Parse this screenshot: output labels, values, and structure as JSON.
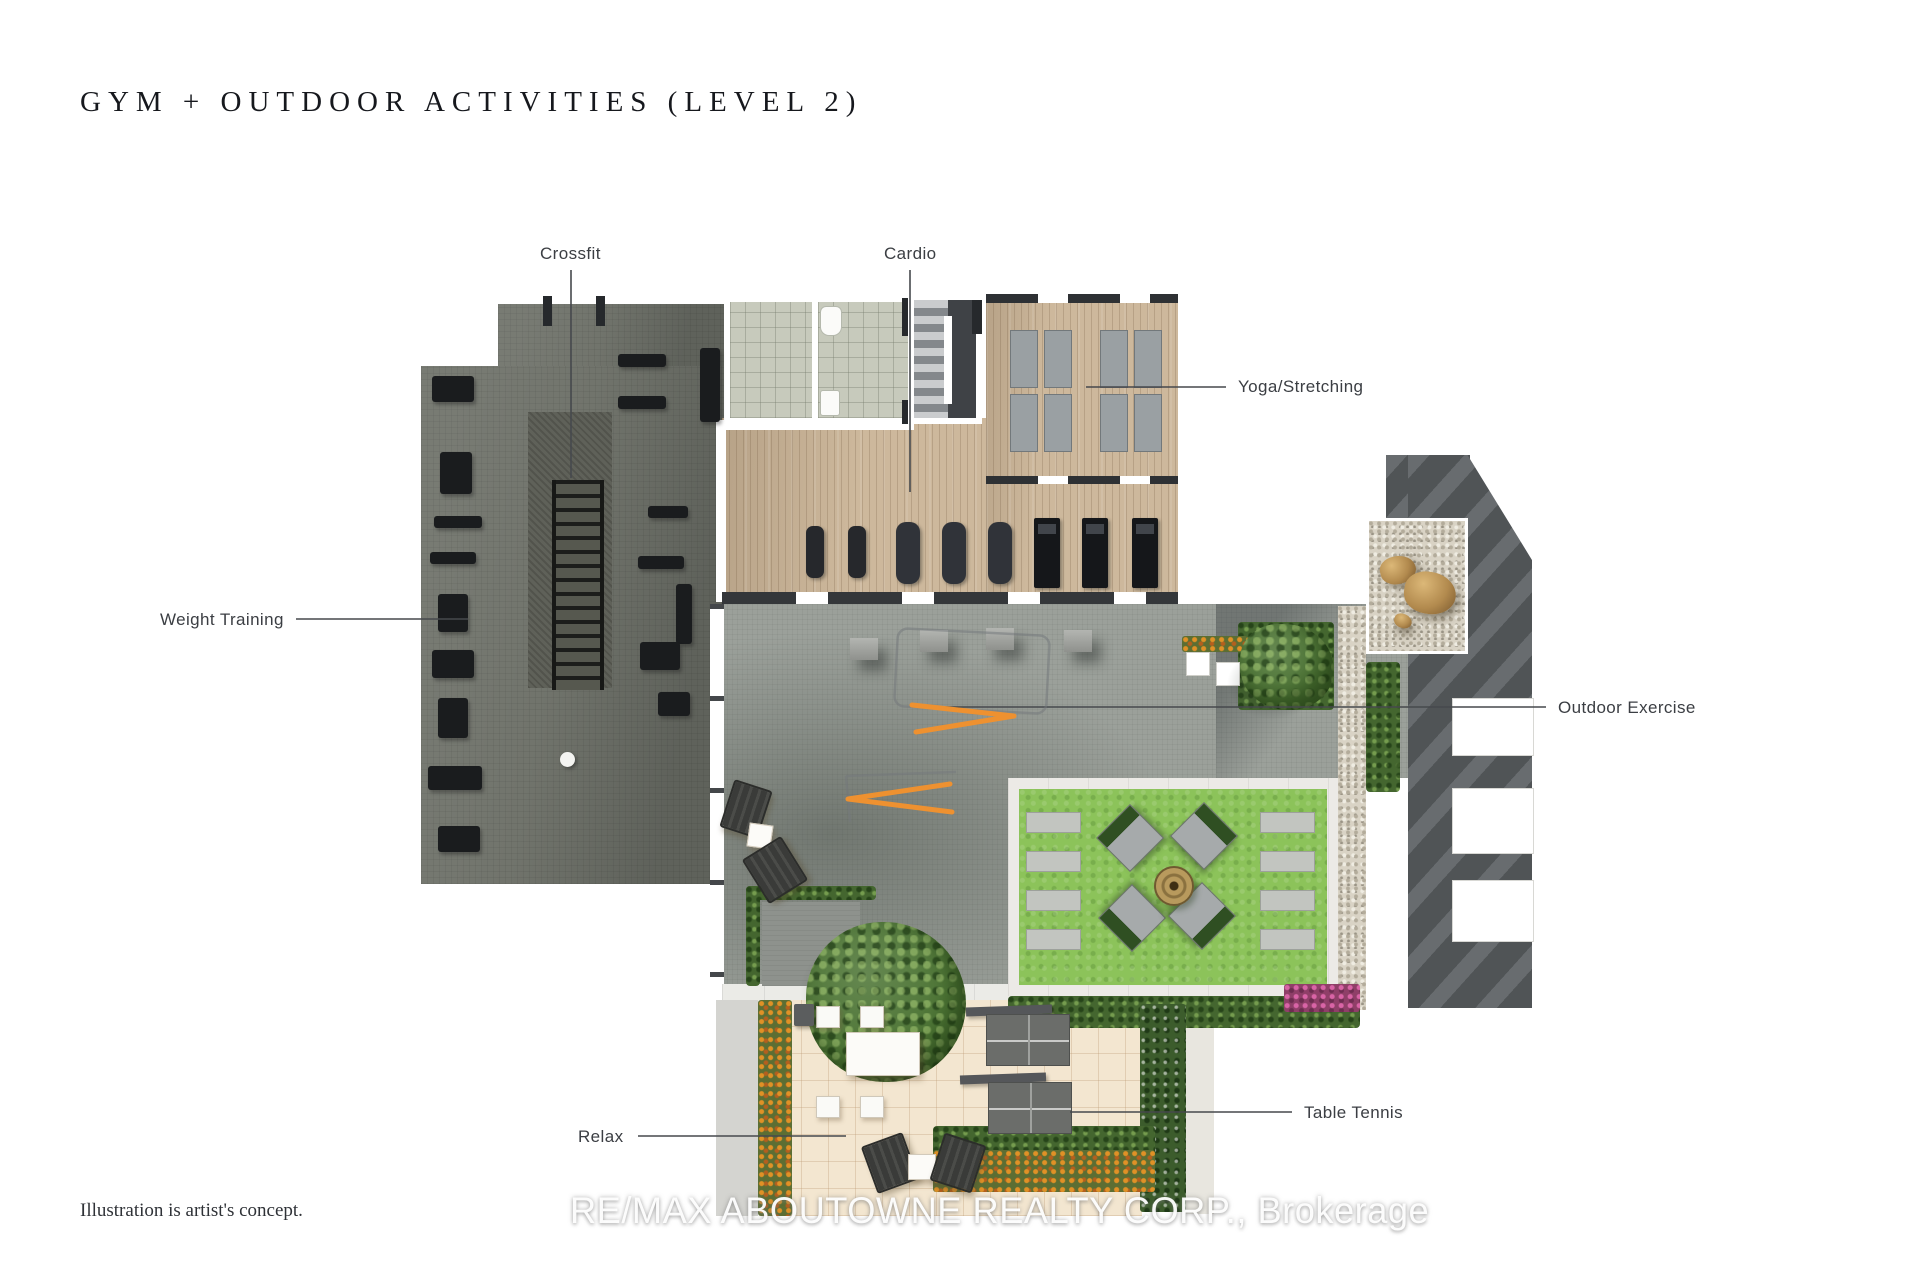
{
  "page": {
    "title": "GYM + OUTDOOR ACTIVITIES (LEVEL 2)",
    "disclaimer": "Illustration is artist's concept.",
    "watermark": "RE/MAX ABOUTOWNE REALTY CORP., Brokerage"
  },
  "plan": {
    "labels": {
      "crossfit": "Crossfit",
      "cardio": "Cardio",
      "yoga": "Yoga/Stretching",
      "weight_training": "Weight Training",
      "outdoor_exercise": "Outdoor Exercise",
      "table_tennis": "Table Tennis",
      "relax": "Relax"
    },
    "colors": {
      "gym_floor": "#71746c",
      "wood_floor": "#cdb89c",
      "terrace_concrete": "#9ba09a",
      "lawn_grass": "#8cc35a",
      "patio_tile": "#f3e6d0",
      "equipment_accent_orange": "#ef9130",
      "hedge_green": "#44662f",
      "label_text": "#3b3e43",
      "title_text": "#16181d"
    }
  }
}
